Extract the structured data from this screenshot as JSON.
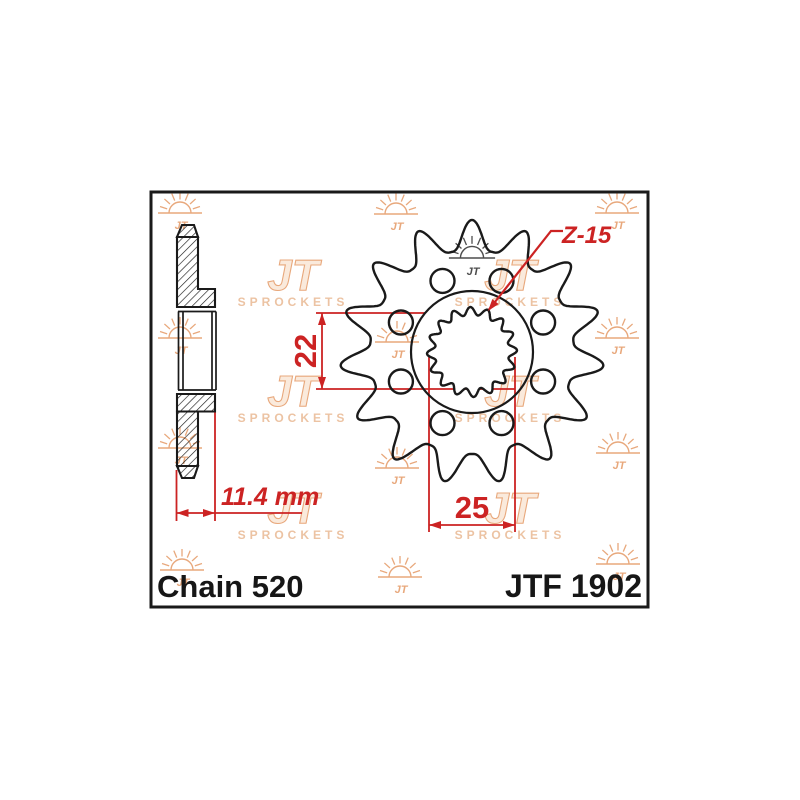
{
  "page": {
    "background": "#ffffff",
    "description": "JT Sprockets technical drawing"
  },
  "drawing": {
    "labels": {
      "chain": "Chain 520",
      "part_number": "JTF 1902",
      "teeth_count": "Z-15",
      "bore_inner_diameter": "22",
      "spline_outer_diameter": "25",
      "thickness": "11.4 mm"
    },
    "colors": {
      "line": "#1a1a1a",
      "dimension_red": "#cc2323",
      "watermark_stroke": "#e8a87c",
      "watermark_fill": "#faeadc",
      "watermark_letters": "#ecc3a3",
      "dark_logo": "#4d4d4d",
      "background": "#ffffff"
    },
    "border": {
      "x": 151,
      "y": 192,
      "width": 497,
      "height": 415,
      "stroke_width": 3
    },
    "front_view": {
      "center_x": 472,
      "center_y": 352,
      "teeth": 15,
      "tip_radius": 132,
      "root_radius": 102,
      "hub_radius": 61,
      "hole_count": 8,
      "hole_ring_radius": 77,
      "hole_radius": 12,
      "hole_start_angle": 22.5,
      "spline_teeth": 16,
      "spline_outer_radius": 45,
      "spline_inner_radius": 37
    },
    "side_view": {
      "left": 177,
      "col_right": 198,
      "flange_right": 215,
      "bore_right": 216,
      "tip_top": 225,
      "chamfer_y": 237,
      "tip_left": 182,
      "tip_right": 194,
      "flange_top_y": 289,
      "bore_top_outer": 307,
      "bore_top_inner": 311.5,
      "bore_bot_inner": 390,
      "bore_bot_outer": 394,
      "flange_bot_y": 411.5,
      "col_bot_y": 466,
      "tip_bot": 478,
      "inner_left": 183,
      "inner_right": 212
    },
    "dimension_geometry": {
      "d22": {
        "line_x": 322,
        "top_y": 313,
        "bot_y": 389,
        "ext_left": 316,
        "ext_top_right": 425,
        "ext_bot_right": 515,
        "text_x": 316,
        "text_y": 351
      },
      "d25": {
        "left_x": 429,
        "right_x": 515,
        "v_top_left": 352,
        "v_top_right": 357,
        "v_bot": 532,
        "line_y": 525,
        "text_x": 472,
        "text_y": 518
      },
      "d114": {
        "left_x": 176.5,
        "right_x": 215,
        "vl_top": 470,
        "vr_top": 410,
        "v_bot": 521,
        "line_y": 513,
        "line_right": 302,
        "text_x": 221,
        "text_y": 505
      },
      "leader": {
        "x1": 563,
        "y1": 231,
        "x2": 551,
        "y2": 231,
        "x3": 489,
        "y3": 309.5,
        "tip_x": 488,
        "tip_y": 311,
        "angle": 128.2,
        "text_x": 562,
        "text_y": 243
      }
    },
    "watermarks": {
      "jt_text": "JT",
      "sprockets_text": "SPROCKETS",
      "sun_positions": [
        [
          180,
          213
        ],
        [
          396,
          214
        ],
        [
          617,
          213
        ],
        [
          180,
          338
        ],
        [
          397,
          342
        ],
        [
          617,
          338
        ],
        [
          180,
          448
        ],
        [
          397,
          468
        ],
        [
          618,
          453
        ],
        [
          182,
          570
        ],
        [
          400,
          577
        ],
        [
          618,
          564
        ]
      ],
      "dark_sun_position": [
        472,
        258
      ],
      "logo_positions": [
        [
          293,
          275
        ],
        [
          510,
          275
        ],
        [
          293,
          391
        ],
        [
          510,
          391
        ],
        [
          293,
          508
        ],
        [
          510,
          508
        ]
      ]
    }
  }
}
